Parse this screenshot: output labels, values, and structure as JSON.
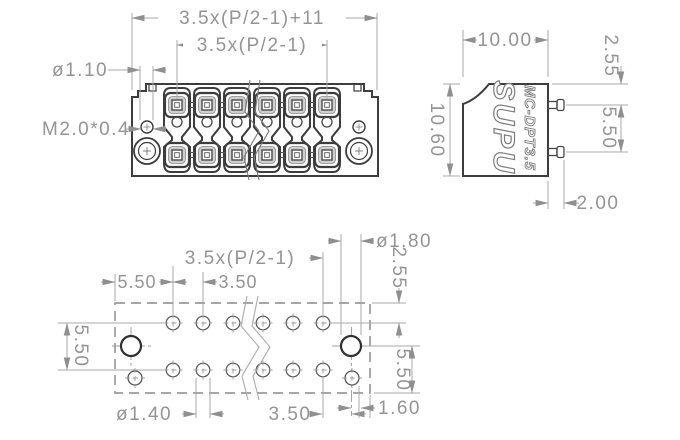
{
  "views": {
    "front": {
      "dims": {
        "overall_width": "3.5x(P/2-1)+11",
        "pitch": "3.5x(P/2-1)",
        "pin_hole_dia": "ø1.10",
        "thread": "M2.0*0.4"
      }
    },
    "side": {
      "brand": "SUPU",
      "model": "MC-DPT3.5",
      "dims": {
        "depth": "10.00",
        "height": "10.60",
        "pin_top_offset": "2.55",
        "pin_row_pitch": "5.50",
        "pin_length": "2.00"
      }
    },
    "bottom": {
      "dims": {
        "pitch": "3.5x(P/2-1)",
        "edge_to_hole": "5.50",
        "hole_pitch": "3.50",
        "row_pitch_left": "5.50",
        "mount_hole_dia": "ø1.80",
        "top_edge_offset": "2.55",
        "row_pitch_right": "5.50",
        "pin_hole_dia": "ø1.40",
        "mount_to_hole": "3.50",
        "mount_to_edge": "1.60"
      }
    }
  },
  "colors": {
    "outline": "#3d3d3d",
    "dimension_lines": "#a8a8a8",
    "text": "#949494"
  }
}
